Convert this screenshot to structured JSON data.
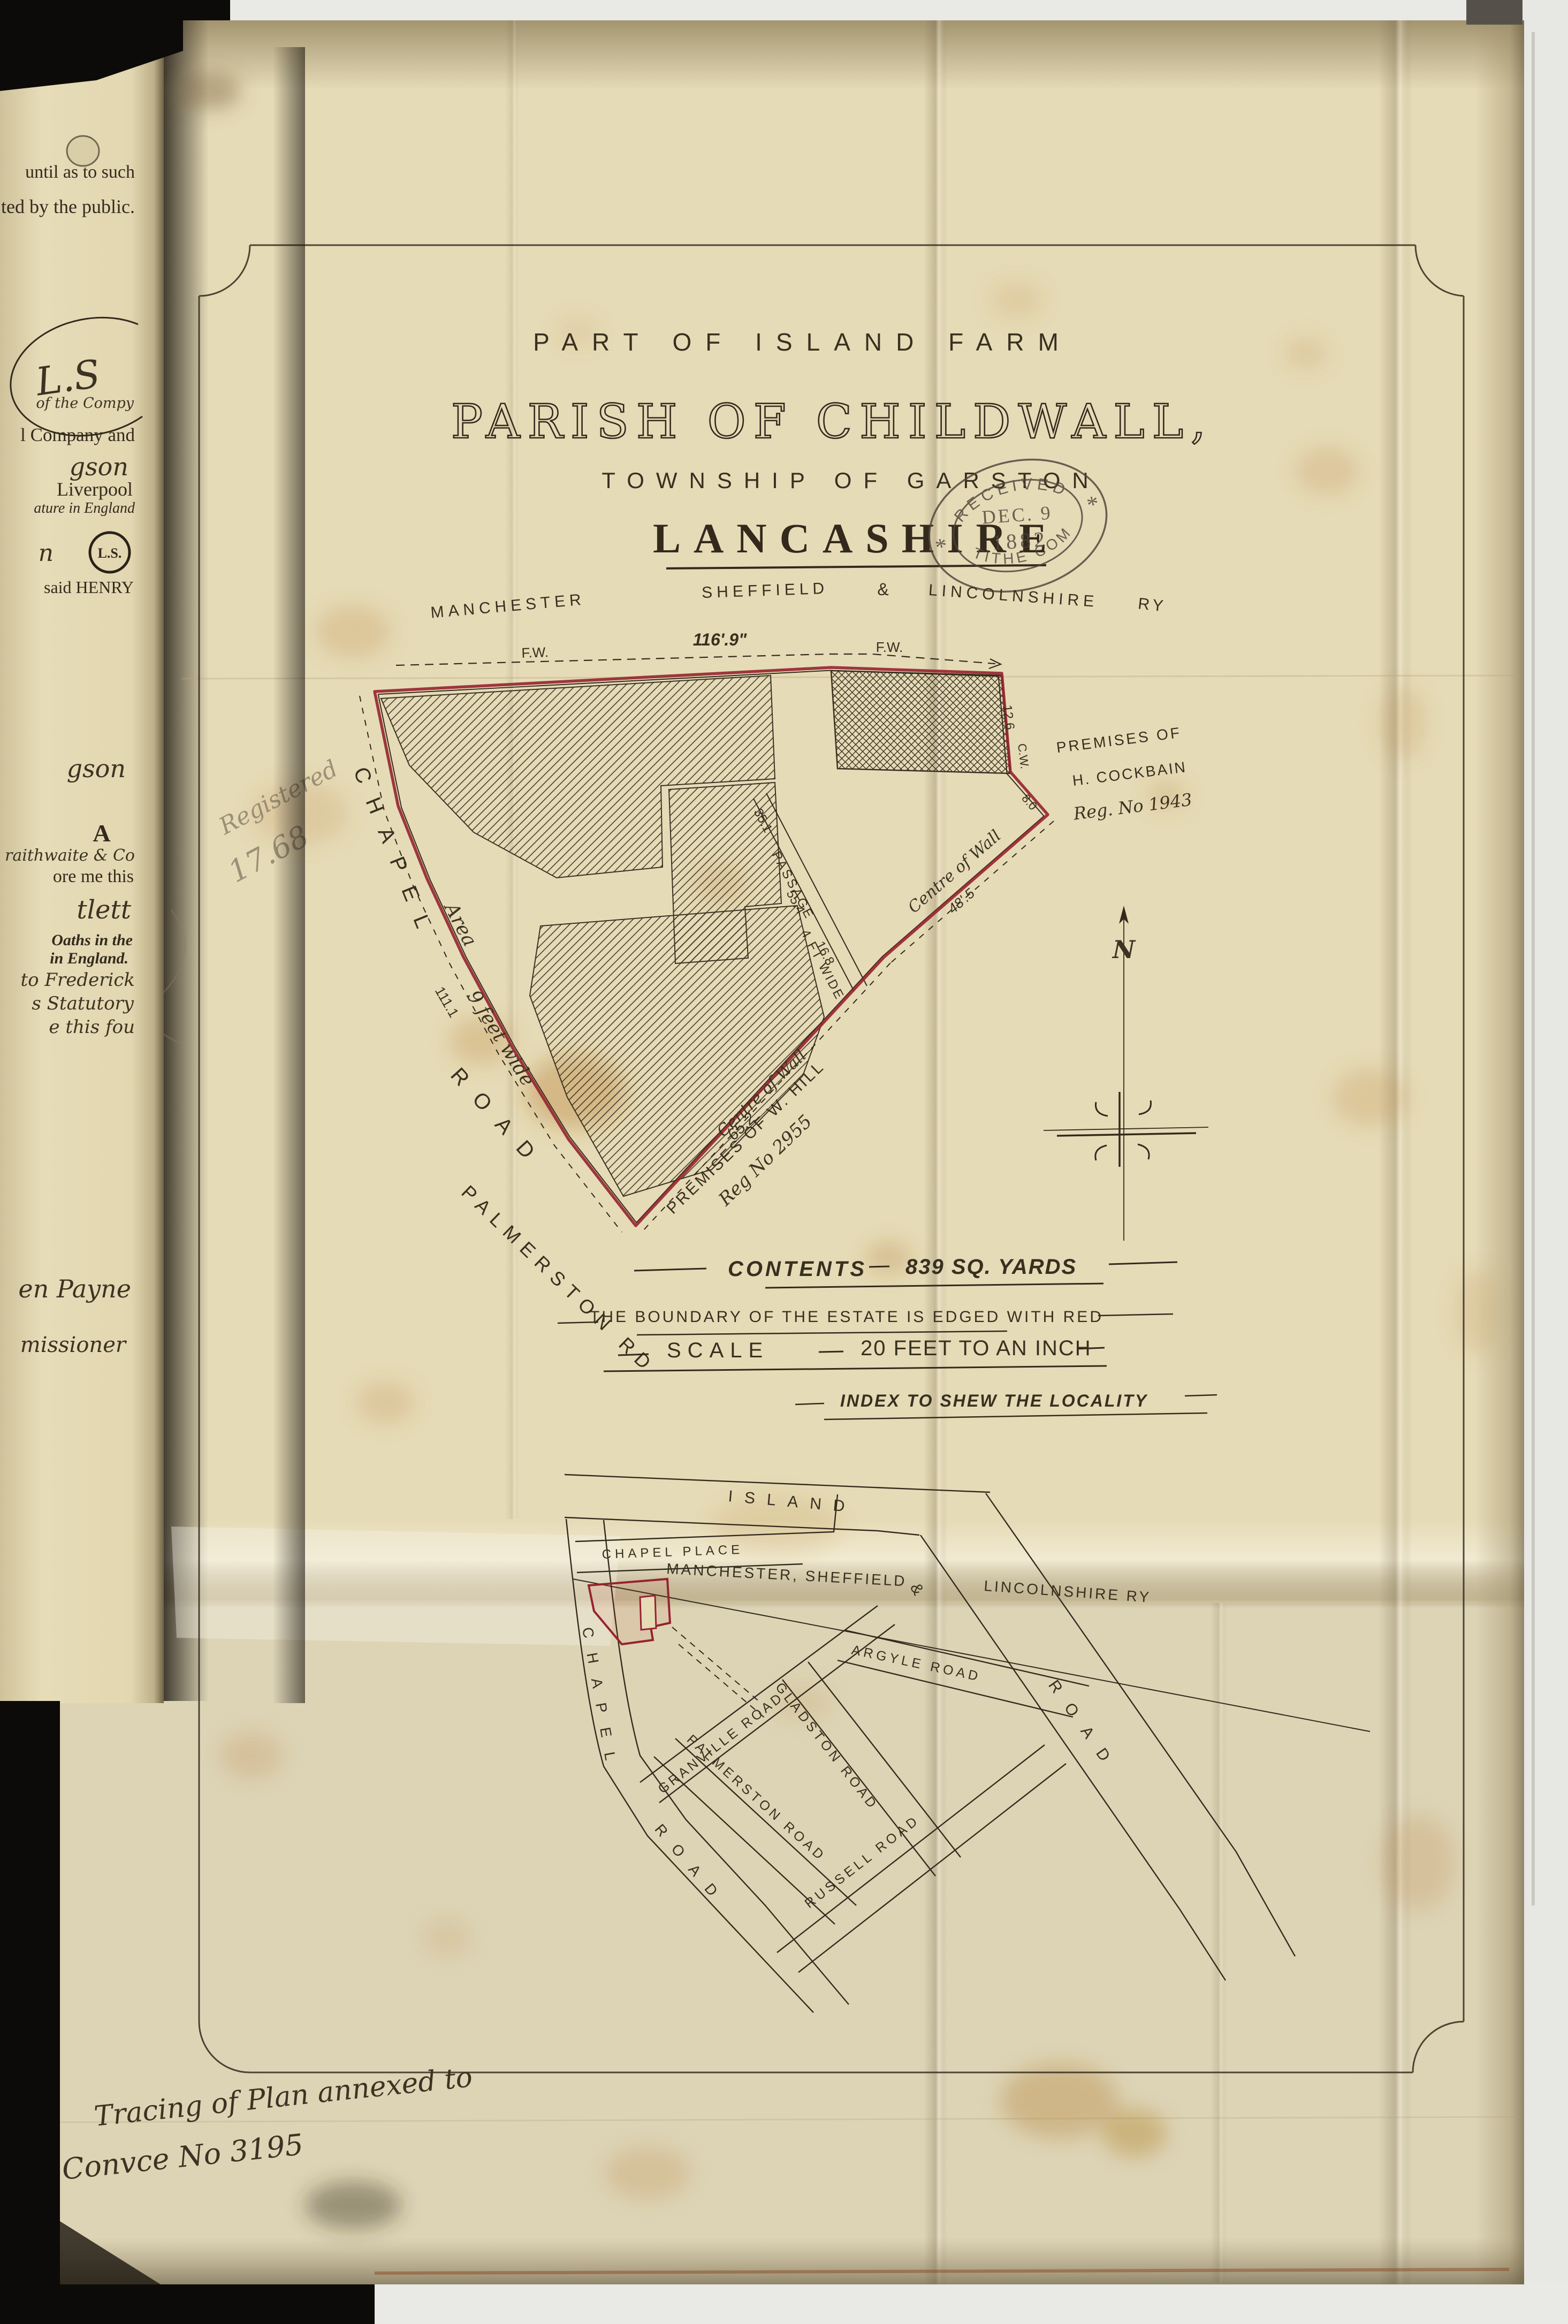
{
  "colors": {
    "boundary_red": "#96232f",
    "ink": "#332a1d",
    "pencil": "#8a7e68",
    "cloth": "#e6dbb7",
    "stamp_ink": "#4d443a"
  },
  "left_page": {
    "fragments": [
      "until as to such",
      "ted by the public.",
      "L.S",
      "of the Compy",
      "l Company and",
      "gson",
      "Liverpool",
      "ature in England",
      "n",
      "said HENRY",
      "gson",
      "A",
      "raithwaite & Co",
      "ore me this",
      "tlett",
      "Oaths in the",
      "in England.",
      "to Frederick",
      "s Statutory",
      "e this fou",
      "en Payne",
      "missioner"
    ],
    "seal_text": "L.S."
  },
  "title": {
    "line1": "PART OF ISLAND FARM",
    "line2": "PARISH OF CHILDWALL,",
    "line3": "TOWNSHIP OF GARSTON",
    "line4": "LANCASHIRE"
  },
  "stamp": {
    "arc_top": "RECEIVED",
    "date_line1": "DEC. 9",
    "date_line2": "1882",
    "arc_bottom": "TITHE COM",
    "ornament": "*"
  },
  "plan": {
    "railway": {
      "w1": "MANCHESTER",
      "w2": "SHEFFIELD",
      "amp": "&",
      "w3": "LINCOLNSHIRE",
      "w4": "RY"
    },
    "fw_left": "F.W.",
    "fw_right": "F.W.",
    "dim_top": "116'.9\"",
    "chapel": "CHAPEL",
    "road": "ROAD",
    "palmerston_rd": "PALMERSTON RD",
    "passage_line1": "PASSAGE",
    "passage_line2": "4 FT WIDE",
    "dims": {
      "d35": "35.1",
      "d55": "55.4",
      "d16": "16.8",
      "d111": "111.1",
      "d12": "12.6",
      "cw": "C.W.",
      "d8": "8.0"
    },
    "area_line1": "Area",
    "area_line2": "9 feet wide",
    "wall1_text": "Centre of Wall",
    "wall1_dim": "48'.5",
    "wall2_text": "Centre of Wall",
    "wall2_dim": "65.2",
    "cockbain_line1": "PREMISES OF",
    "cockbain_line2": "H. COCKBAIN",
    "cockbain_line3": "Reg. No 1943",
    "hill_line1": "PREMISES OF W. HILL",
    "hill_line2": "Reg No 2955",
    "pencil_line1": "Registered",
    "pencil_line2": "17.68",
    "north_mark": "N"
  },
  "notes": {
    "contents_label": "CONTENTS",
    "contents_value": "839 SQ. YARDS",
    "boundary_note": "THE BOUNDARY OF THE ESTATE IS EDGED WITH RED",
    "scale_label": "SCALE",
    "scale_value": "20 FEET TO AN INCH",
    "index_title": "INDEX TO SHEW THE LOCALITY"
  },
  "index_map": {
    "island": "ISLAND",
    "road_diagonal": "ROAD",
    "chapel_place": "CHAPEL PLACE",
    "railway_line1": "MANCHESTER, SHEFFIELD",
    "railway_amp": "&",
    "railway_line2": "LINCOLNSHIRE RY",
    "chapel": "CHAPEL",
    "chapel_road_word": "ROAD",
    "granville": "GRANVILLE ROAD",
    "palmerston": "PALMERSTON ROAD",
    "gladston": "GLADSTON ROAD",
    "argyle": "ARGYLE ROAD",
    "russell": "RUSSELL ROAD"
  },
  "footer_note": {
    "line1": "Tracing of Plan annexed to",
    "line2": "Convce No 3195"
  }
}
